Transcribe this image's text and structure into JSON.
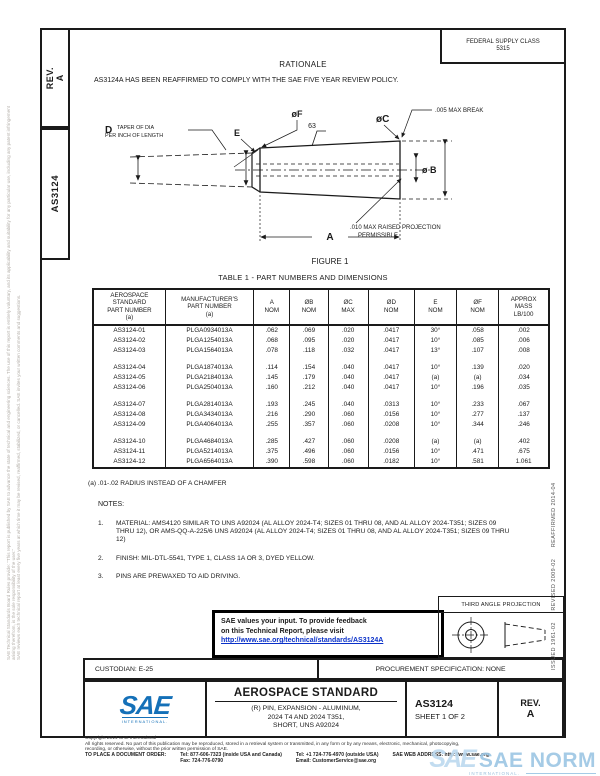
{
  "colors": {
    "accent_blue": "#1470b8",
    "link_blue": "#0a31c9",
    "watermark_blue": "#9cc6e4"
  },
  "sidebar": {
    "rev_label": "REV.\nA",
    "doc_number": "AS3124"
  },
  "margins": {
    "left1": "SAE Technical Standards Board Rules provide: \"This report is published by SAE to advance the state of technical and engineering sciences. The use of this report is entirely voluntary, and its applicability and suitability for any particular use, including any patent infringement arising therefrom, is the sole responsibility of the user.\"",
    "left2": "SAE reviews each technical report at least every five years at which time it may be revised, reaffirmed, stabilized, or cancelled. SAE invites your written comments and suggestions.",
    "right": "ISSUED 1961-02      REVISED 2009-02      REAFFIRMED 2014-04"
  },
  "header": {
    "supply_class_line1": "FEDERAL SUPPLY CLASS",
    "supply_class_line2": "5315"
  },
  "rationale": {
    "title": "RATIONALE",
    "text": "AS3124A HAS BEEN REAFFIRMED TO COMPLY WITH THE SAE FIVE YEAR REVIEW POLICY."
  },
  "figure": {
    "caption": "FIGURE 1",
    "d_letter": "D",
    "d_note1": "TAPER OF DIA",
    "d_note2": "PER INCH OF LENGTH",
    "e_label": "E",
    "f_label": "øF",
    "finish": "63",
    "break_note": ".005 MAX BREAK",
    "c_label": "øC",
    "b_label": "ø B",
    "proj_note1": ".010 MAX RAISED PROJECTION",
    "proj_note2": "PERMISSIBLE",
    "a_label": "A"
  },
  "table": {
    "title": "TABLE 1 - PART NUMBERS AND DIMENSIONS",
    "columns": [
      {
        "lines": [
          "AEROSPACE",
          "STANDARD",
          "PART NUMBER",
          "(a)"
        ]
      },
      {
        "lines": [
          "MANUFACTURER'S",
          "PART NUMBER",
          "(a)"
        ]
      },
      {
        "lines": [
          "A",
          "NOM"
        ]
      },
      {
        "lines": [
          "ØB",
          "NOM"
        ]
      },
      {
        "lines": [
          "ØC",
          "MAX"
        ]
      },
      {
        "lines": [
          "ØD",
          "NOM"
        ]
      },
      {
        "lines": [
          "E",
          "NOM"
        ]
      },
      {
        "lines": [
          "ØF",
          "NOM"
        ]
      },
      {
        "lines": [
          "APPROX",
          "MASS",
          "LB/100"
        ]
      }
    ],
    "rows": [
      [
        "AS3124-01",
        "PLGA0934013A",
        ".062",
        ".069",
        ".020",
        ".0417",
        "30°",
        ".058",
        ".002"
      ],
      [
        "AS3124-02",
        "PLGA1254013A",
        ".068",
        ".095",
        ".020",
        ".0417",
        "10°",
        ".085",
        ".006"
      ],
      [
        "AS3124-03",
        "PLGA1564013A",
        ".078",
        ".118",
        ".032",
        ".0417",
        "13°",
        ".107",
        ".008"
      ],
      [
        "AS3124-04",
        "PLGA1874013A",
        ".114",
        ".154",
        ".040",
        ".0417",
        "10°",
        ".139",
        ".020"
      ],
      [
        "AS3124-05",
        "PLGA2184013A",
        ".145",
        ".179",
        ".040",
        ".0417",
        "(a)",
        "(a)",
        ".034"
      ],
      [
        "AS3124-06",
        "PLGA2504013A",
        ".160",
        ".212",
        ".040",
        ".0417",
        "10°",
        ".196",
        ".035"
      ],
      [
        "AS3124-07",
        "PLGA2814013A",
        ".193",
        ".245",
        ".040",
        ".0313",
        "10°",
        ".233",
        ".067"
      ],
      [
        "AS3124-08",
        "PLGA3434013A",
        ".216",
        ".290",
        ".060",
        ".0156",
        "10°",
        ".277",
        ".137"
      ],
      [
        "AS3124-09",
        "PLGA4064013A",
        ".255",
        ".357",
        ".060",
        ".0208",
        "10°",
        ".344",
        ".246"
      ],
      [
        "AS3124-10",
        "PLGA4684013A",
        ".285",
        ".427",
        ".060",
        ".0208",
        "(a)",
        "(a)",
        ".402"
      ],
      [
        "AS3124-11",
        "PLGA5214013A",
        ".375",
        ".496",
        ".060",
        ".0156",
        "10°",
        ".471",
        ".675"
      ],
      [
        "AS3124-12",
        "PLGA6564013A",
        ".390",
        ".598",
        ".060",
        ".0182",
        "10°",
        ".581",
        "1.061"
      ]
    ]
  },
  "footnote": "(a)  .01-.02 RADIUS INSTEAD OF A CHAMFER",
  "notes": {
    "title": "NOTES:",
    "items": [
      {
        "num": "1.",
        "text": "MATERIAL:  AMS4120 SIMILAR TO UNS A92024 (AL ALLOY 2024-T4; SIZES 01 THRU 08, AND AL ALLOY 2024-T351; SIZES 09 THRU 12), OR AMS-QQ-A-225/6 UNS A92024 (AL ALLOY 2024-T4; SIZES 01 THRU 08, AND AL ALLOY 2024-T351; SIZES 09 THRU 12)"
      },
      {
        "num": "2.",
        "text": "FINISH:  MIL-DTL-5541, TYPE 1, CLASS 1A OR 3, DYED YELLOW."
      },
      {
        "num": "3.",
        "text": "PINS ARE PREWAXED TO AID DRIVING."
      }
    ]
  },
  "feedback": {
    "line1": "SAE values your input. To provide feedback",
    "line2": "on this Technical Report, please visit",
    "link": "http://www.sae.org/technical/standards/AS3124A"
  },
  "projection": {
    "label": "THIRD ANGLE PROJECTION"
  },
  "bars": {
    "custodian": "CUSTODIAN: E-25",
    "procurement": "PROCUREMENT SPECIFICATION: NONE"
  },
  "title_block": {
    "logo": "SAE",
    "logo_sub": "INTERNATIONAL.",
    "standard": "AEROSPACE STANDARD",
    "subtitle1": "(R) PIN, EXPANSION - ALUMINUM,",
    "subtitle2": "2024 T4 AND 2024 T351,",
    "subtitle3": "SHORT, UNS A92024",
    "number": "AS3124",
    "sheet": "SHEET 1 OF 2",
    "rev_label": "REV.",
    "rev_value": "A"
  },
  "footer": {
    "copyright1": "Copyright 2014 SAE International",
    "copyright2": "All rights reserved. No part of this publication may be reproduced, stored in a retrieval system or transmitted, in any form or by any means, electronic, mechanical, photocopying,",
    "copyright3": "recording, or otherwise, without the prior written permission of SAE.",
    "order_label": "TO PLACE A DOCUMENT ORDER:",
    "tel1": "Tel: 877-606-7323 (inside USA and Canada)",
    "fax": "Fax: 724-776-0790",
    "tel2": "Tel: +1 724-776-4970 (outside USA)",
    "email": "Email: CustomerService@sae.org",
    "web": "SAE WEB ADDRESS: http://www.sae.org"
  },
  "watermark": {
    "logo": "SAE",
    "text": "SAE NORM",
    "sub": "INTERNATIONAL."
  }
}
